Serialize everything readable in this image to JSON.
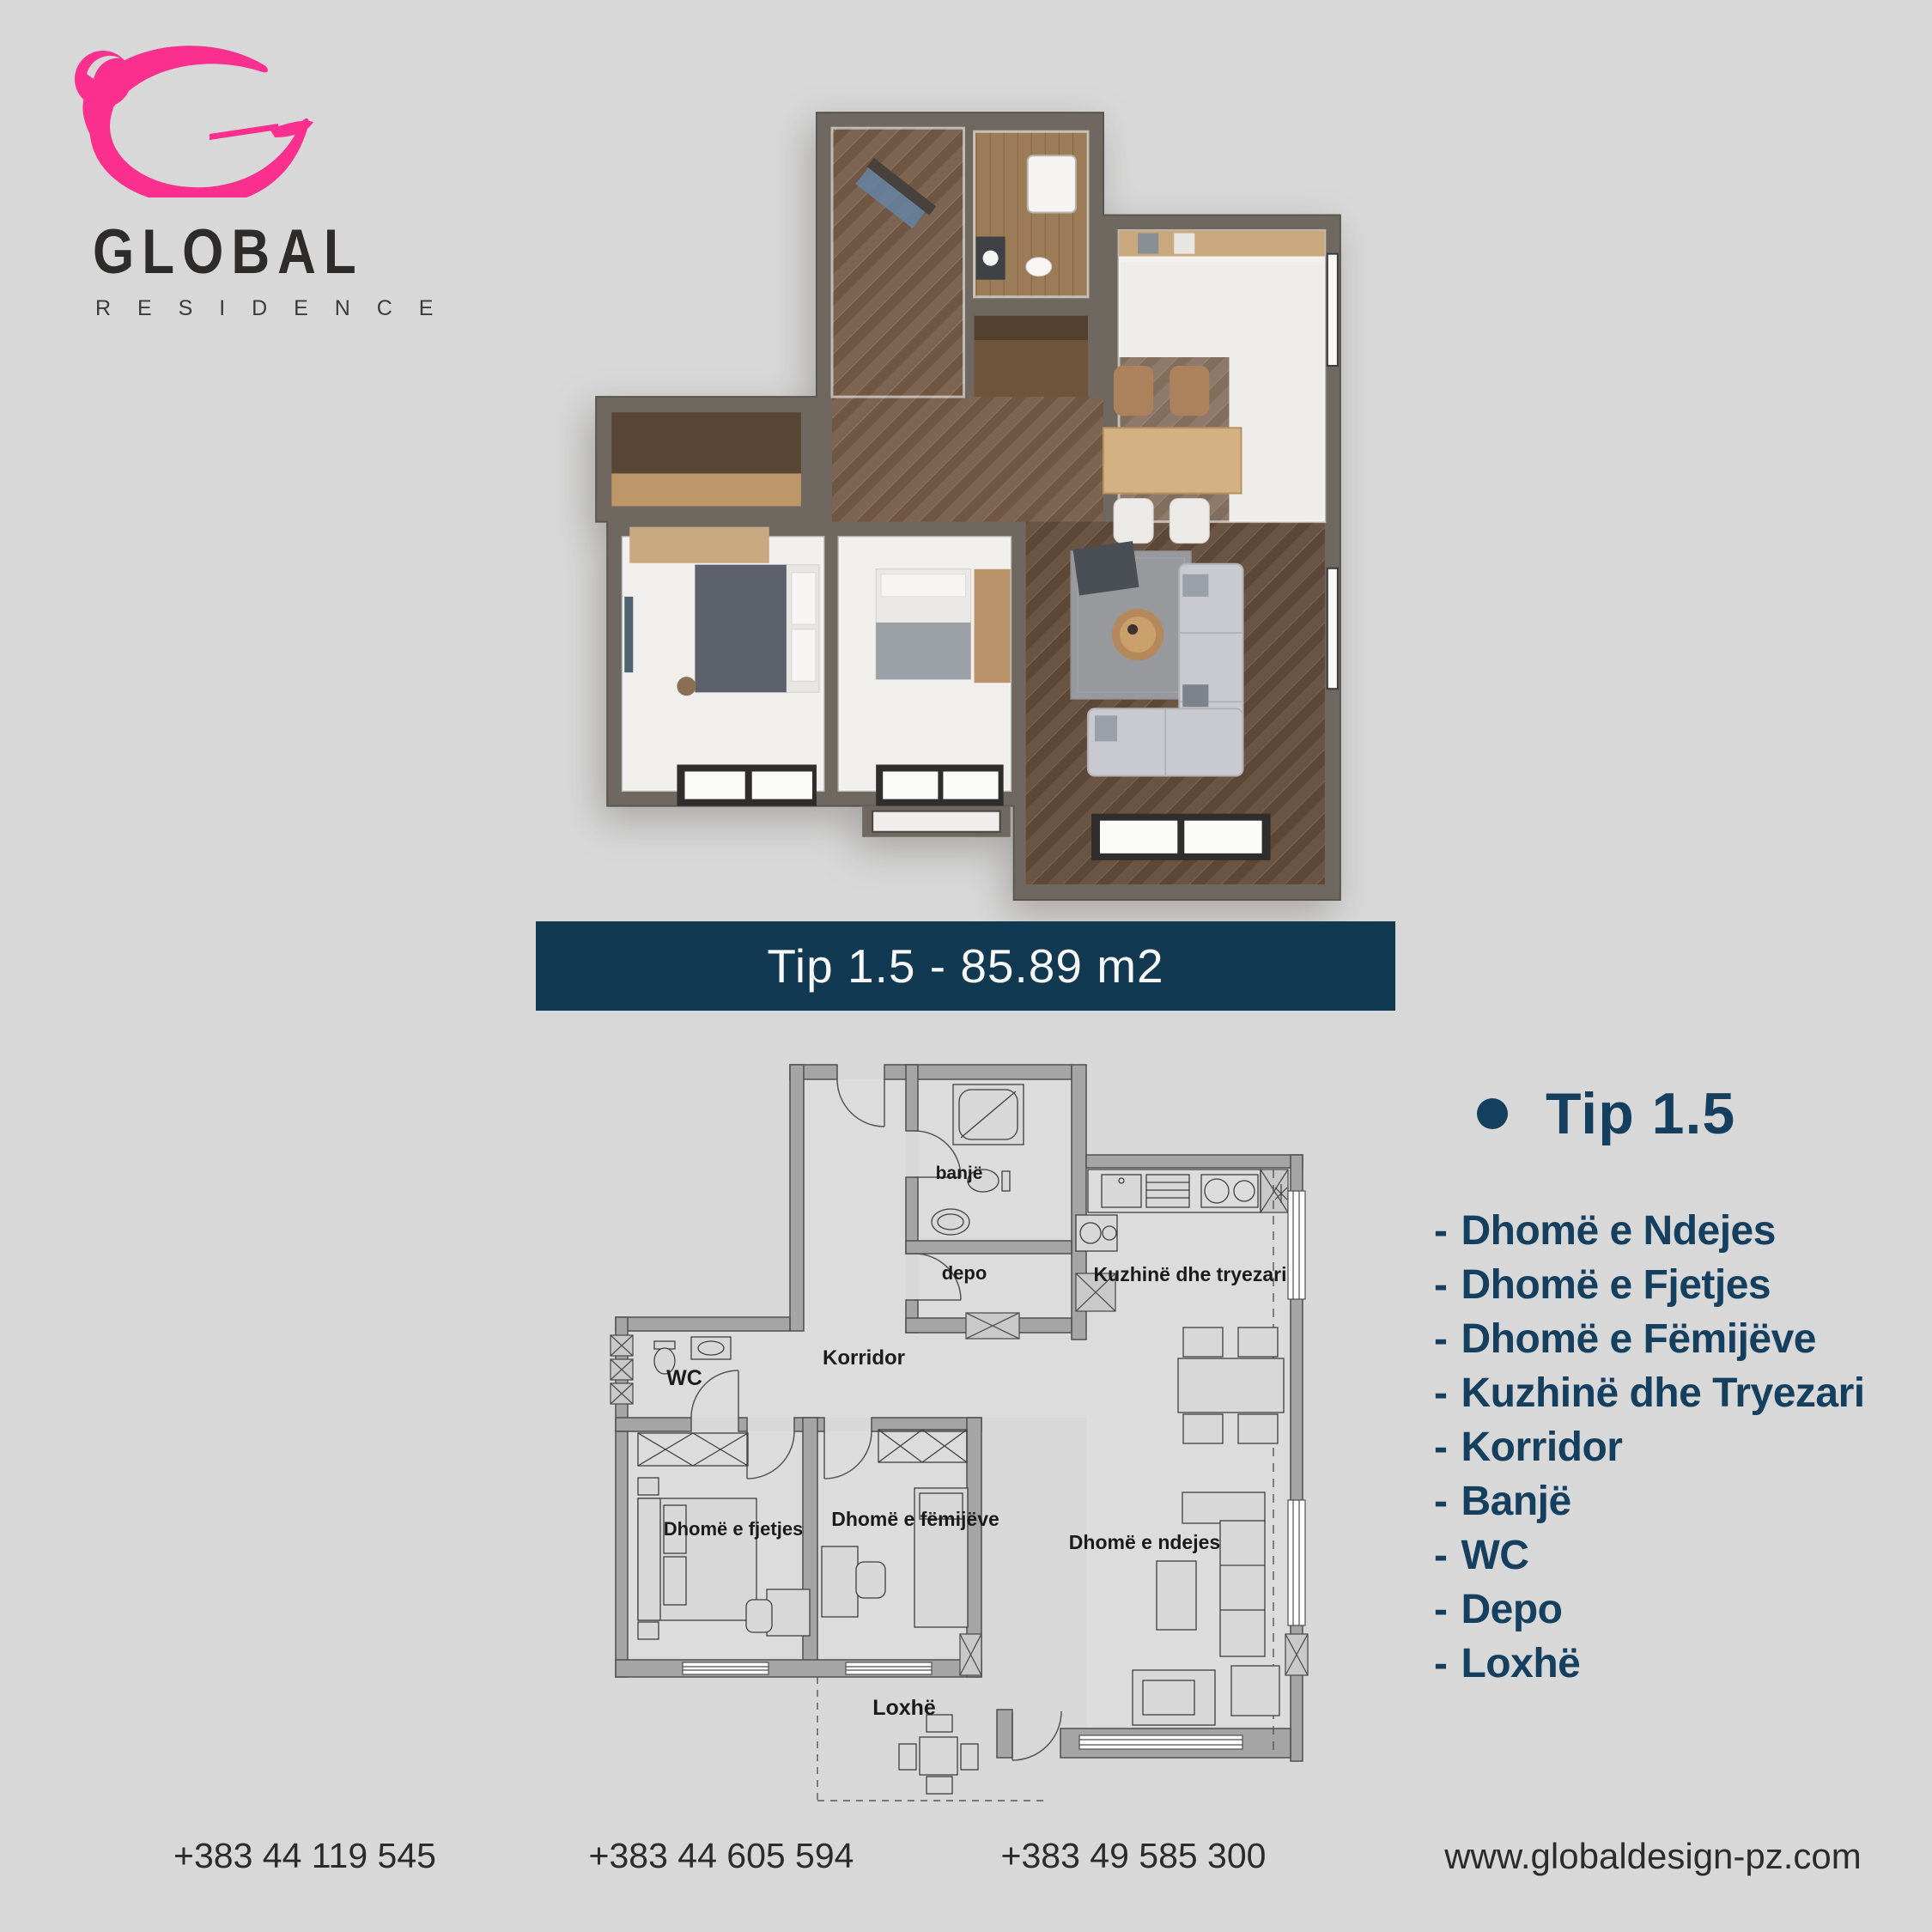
{
  "brand": {
    "logo_text": "GLOBAL",
    "logo_subtext": "R E S I D E N C E"
  },
  "banner": {
    "label": "Tip 1.5 - 85.89 m2"
  },
  "unit_info": {
    "title": "Tip 1.5",
    "item_prefix": "-",
    "rooms": [
      "Dhomë e Ndejes",
      "Dhomë e Fjetjes",
      "Dhomë e Fëmijëve",
      "Kuzhinë dhe Tryezari",
      "Korridor",
      "Banjë",
      "WC",
      "Depo",
      "Loxhë"
    ]
  },
  "floorplan": {
    "labels": {
      "banje": "banjë",
      "depo": "depo",
      "kuzhine": "Kuzhinë dhe tryezari",
      "wc": "WC",
      "korridor": "Korridor",
      "fjetjes": "Dhomë e fjetjes",
      "femijeve": "Dhomë e fëmijëve",
      "ndejes": "Dhomë e ndejes",
      "loxhe": "Loxhë"
    }
  },
  "footer": {
    "phone_1": "+383 44 119 545",
    "phone_2": "+383 44 605 594",
    "phone_3": "+383 49 585 300",
    "website": "www.globaldesign-pz.com"
  },
  "colors": {
    "background": "#d8d8d8",
    "banner_bg": "#113a52",
    "accent_navy": "#143f5e",
    "logo_pink": "#fb2f8e",
    "wall_3d": "#6e6860",
    "wall_2d": "#a5a5a5"
  }
}
